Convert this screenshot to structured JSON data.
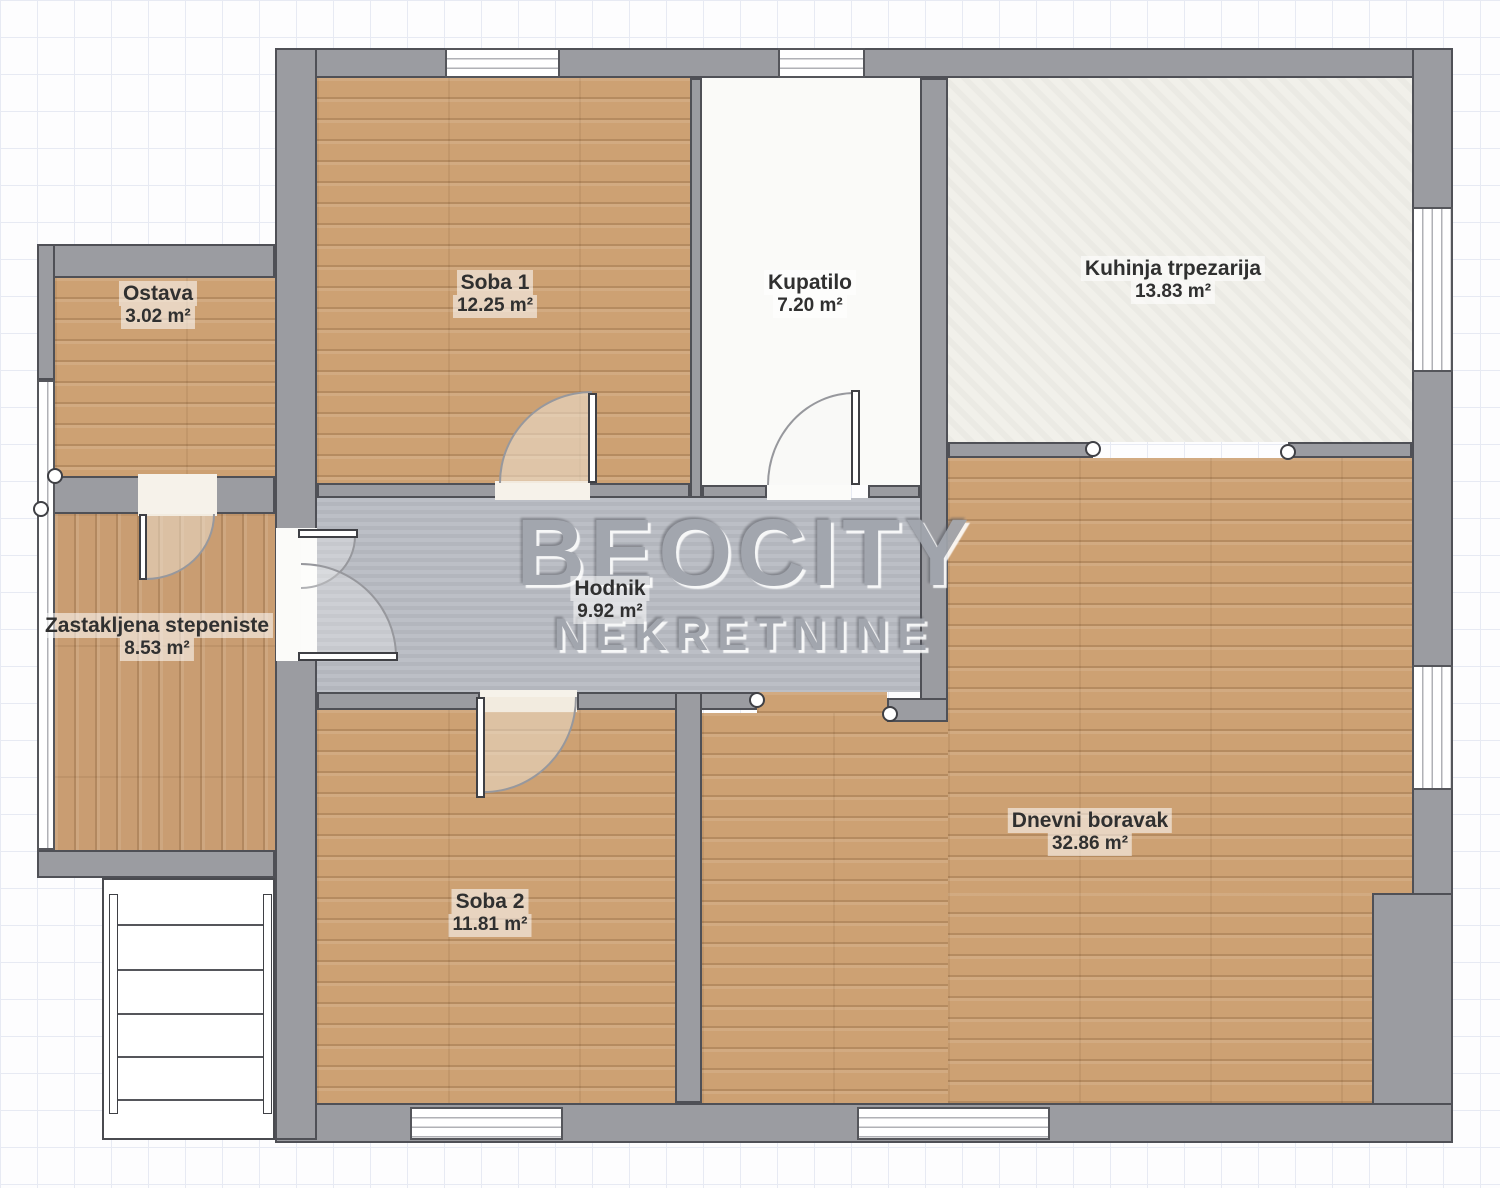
{
  "watermark": {
    "line1": "BEOCITY",
    "line2": "NEKRETNINE"
  },
  "rooms": {
    "ostava": {
      "name": "Ostava",
      "area": "3.02 m²"
    },
    "soba1": {
      "name": "Soba 1",
      "area": "12.25 m²"
    },
    "kupatilo": {
      "name": "Kupatilo",
      "area": "7.20 m²"
    },
    "kuhinja": {
      "name": "Kuhinja trpezarija",
      "area": "13.83 m²"
    },
    "stepeniste": {
      "name": "Zastakljena stepeniste",
      "area": "8.53 m²"
    },
    "hodnik": {
      "name": "Hodnik",
      "area": "9.92 m²"
    },
    "soba2": {
      "name": "Soba 2",
      "area": "11.81 m²"
    },
    "dnevni": {
      "name": "Dnevni boravak",
      "area": "32.86 m²"
    }
  }
}
